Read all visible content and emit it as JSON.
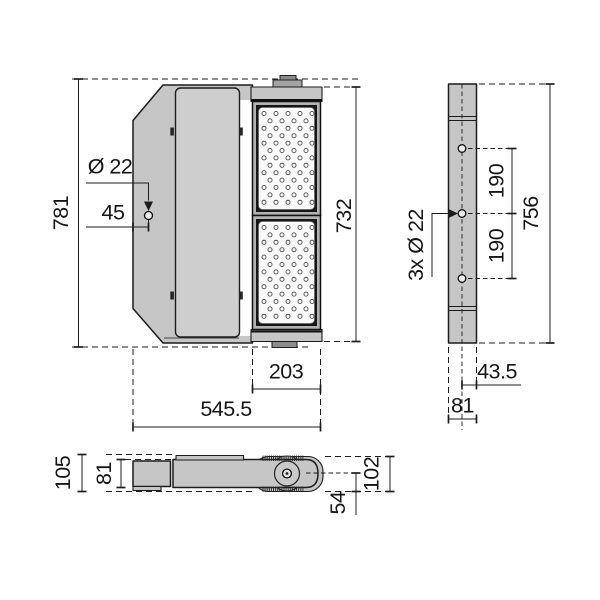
{
  "drawing": {
    "front": {
      "overall_height": "781",
      "module_height": "732",
      "hole_dia": "Ø 22",
      "hole_offset": "45",
      "module_width": "203",
      "overall_width": "545.5"
    },
    "side": {
      "spacing_top": "190",
      "spacing_bottom": "190",
      "height": "756",
      "holes": "3x Ø 22",
      "edge_offset": "43.5",
      "depth": "81"
    },
    "bottom": {
      "overall": "105",
      "body": "81",
      "yoke": "102",
      "pivot": "54"
    },
    "led_grid": {
      "rows": 13,
      "cols_even": 5,
      "cols_odd": 4,
      "dx": 12,
      "dy": 7.4,
      "x_even": 264,
      "x_odd": 270,
      "dot_r": 2.05
    },
    "colors": {
      "body": "#c6c6c6",
      "line": "#1c1c1c",
      "frame_dark": "#161616",
      "led_panel": "#fafafa",
      "background": "#ffffff"
    }
  }
}
